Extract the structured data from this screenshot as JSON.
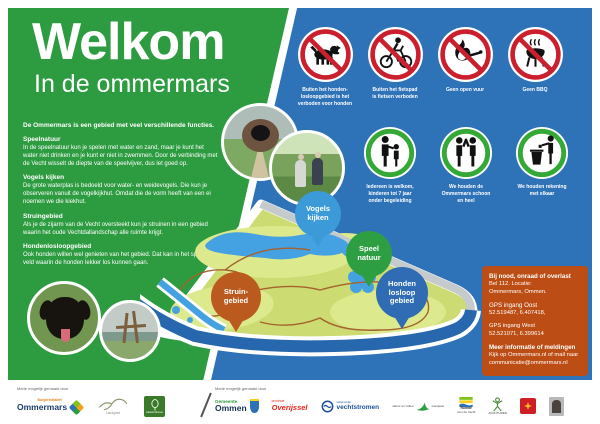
{
  "colors": {
    "panel_green": "#2d9b3f",
    "panel_blue": "#2e72b8",
    "info_box_orange": "#bc4d15",
    "prohibition_red": "#cc1f2e",
    "guideline_green": "#35a935",
    "map_land": "#ccdb72",
    "map_water": "#45a2e2",
    "map_river": "#2767ad"
  },
  "header": {
    "title": "Welkom",
    "subtitle": "In de ommermars"
  },
  "left_panel": {
    "intro": "De Ommermars is een gebied met veel verschillende functies.",
    "sections": [
      {
        "title": "Speelnatuur",
        "body": "In de speelnatuur kun je spelen met water en zand, maar je kunt het water niet drinken en je kunt er niet in zwemmen. Door de verbinding met de Vecht wisselt de diepte van de speelvijver, dus let goed op."
      },
      {
        "title": "Vogels kijken",
        "body": "De grote waterplas is bedoeld voor water- en weidevogels. Die kun je observeren vanuit de vogelkijkhut. Omdat die de vorm heeft van een ei noemen we die kiekhut."
      },
      {
        "title": "Struingebied",
        "body": "Als je de zijarm van de Vecht oversteekt kun je struinen in een gebied waarin het oude Vechtdallandschap alle ruimte krijgt."
      },
      {
        "title": "Hondenlosloopgebied",
        "body": "Ook honden willen wel genieten van het gebied. Dat kan in het speciale veld waarin de honden lekker los kunnen gaan."
      }
    ]
  },
  "rules": [
    {
      "icon": "no-dogs",
      "caption": "Buiten het honden-\nlosloopgebied is het\nverboden voor honden"
    },
    {
      "icon": "no-cycling",
      "caption": "Buiten het fietspad\nis fietsen verboden"
    },
    {
      "icon": "no-open-fire",
      "caption": "Geen open vuur"
    },
    {
      "icon": "no-bbq",
      "caption": "Geen BBQ"
    }
  ],
  "guidelines": [
    {
      "icon": "adult-and-child",
      "caption": "Iedereen is welkom,\nkinderen tot 7 jaar\nonder begeleiding"
    },
    {
      "icon": "high-five",
      "caption": "We houden de\nOmmermars schoon\nen heel"
    },
    {
      "icon": "person-with-bin",
      "caption": "We houden rekening\nmet elkaar"
    }
  ],
  "map": {
    "pins": [
      {
        "label": "Vogels\nkijken",
        "color": "#3d9ad8"
      },
      {
        "label": "Speel\nnatuur",
        "color": "#2e9e43"
      },
      {
        "label": "Struin-\ngebied",
        "color": "#bb5a1e"
      },
      {
        "label": "Honden\nlosloop\ngebied",
        "color": "#2f6cb3"
      }
    ]
  },
  "info_box": {
    "emergency_title": "Bij nood, onraad of overlast",
    "emergency_body": "Bel 112. Locatie:\nOmmermars, Ommen.",
    "gps_east_label": "GPS ingang Oost",
    "gps_east": "52.519487, 6.407418,",
    "gps_west_label": "GPS ingang West",
    "gps_west": "52.521071, 6.399614",
    "info_title": "Meer informatie of meldingen",
    "info_body": "Kijk op Ommermars.nl of mail naar\ncommunicatie@ommermars.nl"
  },
  "footer": {
    "credit_left": "Mede mogelijk gemaakt door",
    "credit_right": "Mede mogelijk gemaakt door",
    "ommermars_small": "Burgerinitiatief",
    "ommermars": "Ommermars",
    "landgoed": "Landgoed",
    "staatsbosbeheer": "staatsbosbeheer",
    "gemeente_small": "Gemeente",
    "gemeente": "Ommen",
    "provincie_small": "provincie",
    "provincie": "Overijssel",
    "vechtstromen_small": "waterschap",
    "vechtstromen": "vechtstromen",
    "natuurmilieu_a": "natuur en milieu",
    "natuurmilieu_b": "overijssel",
    "ruimte_a": "Ruimte",
    "ruimte_b": "voor de Vecht",
    "avonturen": "AVONTUREN"
  }
}
